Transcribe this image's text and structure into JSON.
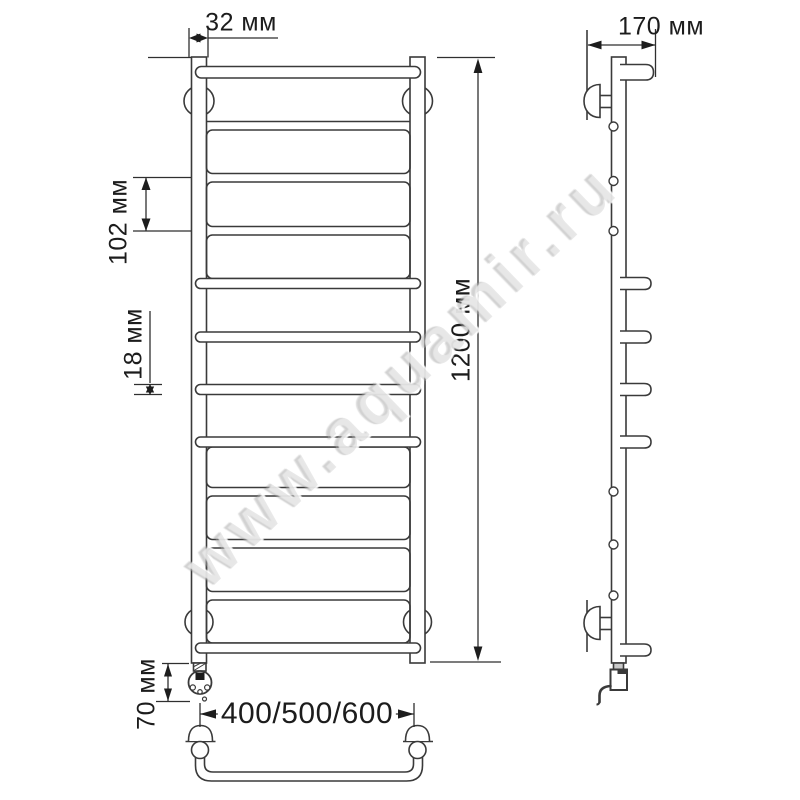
{
  "watermark": "www.aquamir.ru",
  "dimensions": {
    "collector_width": "32 мм",
    "depth": "170 мм",
    "rung_pitch": "102 мм",
    "rung_diameter": "18 мм",
    "height": "1200 мм",
    "heater_stub": "70 мм",
    "width_options": "400/500/600"
  },
  "figure": {
    "views": [
      "front",
      "side",
      "bottom"
    ],
    "rungs_total": 12,
    "flat_rungs": 6,
    "protruding_rungs": 6,
    "line_color": "#3a3a3a",
    "background_color": "#ffffff"
  }
}
